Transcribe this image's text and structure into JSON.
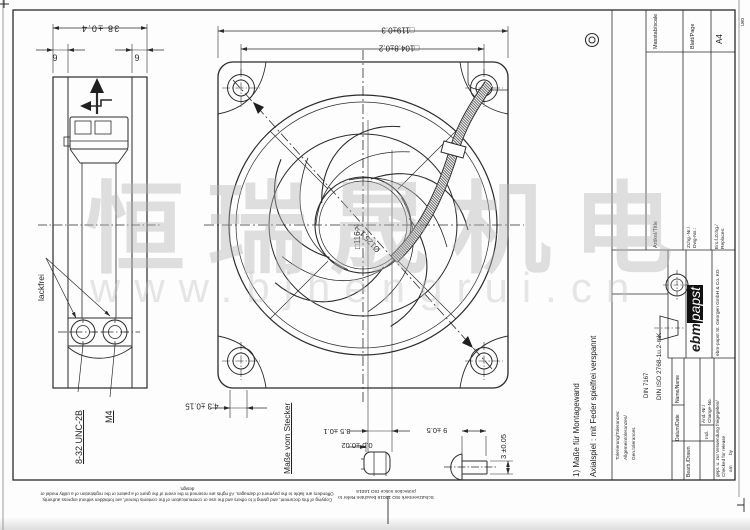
{
  "sheet": {
    "format": "A4",
    "edge_initials": "uvo"
  },
  "watermark": {
    "cjk": "恒瑞晟机电",
    "url": "www.bjhengrui.cn"
  },
  "dims": {
    "side_width": "38 ±0.4",
    "side_flange_l": "6",
    "side_flange_r": "6",
    "front_outer": "□119±0.3",
    "front_holes": "□104.8±0.2",
    "cutout_square": "□116 ¹)",
    "cutout_dia": "Ø125.1 ¹)",
    "plate_thk": "4.3 ±0.15",
    "plug_lip": "0.5 ±0.02",
    "plug_dia": "8.5 ±0.1",
    "pin_len": "9 ±0.5",
    "pin_dia": "3 ±0.05"
  },
  "labels": {
    "paint_free": "lackfrei",
    "thread_unc": "8-32 UNC-2B",
    "thread_m4": "M4",
    "plug_title": "Maße vom Stecker"
  },
  "notes": {
    "footnote1": "1) Maße für Montagewand",
    "footnote2": "Axialspiel : mit Feder spielfrei verspannt",
    "protect_de": "Schutzvermerk ISO 16016 beachten",
    "protect_en": "Refer to protection notice ISO 16016",
    "copyright": "Copying of this document, and giving it to others and the use or communication of the contents thereof, are forbidden without express authority. Offenders are liable to the payment of damages. All rights are reserved in the event of the grant of a patent or the registration of a utility model or design."
  },
  "titleblock": {
    "scale_label": "Masstab/scale",
    "sheet_label": "Blatt/Page",
    "sheet_value": "A4",
    "article_label": "Artikel/Title",
    "dwg_label1": "Zchg.-Nr./",
    "dwg_label2": "Dwg-No.:",
    "repl_label1": "Ers.f.Zchg./",
    "repl_label2": "Replaces:",
    "tol_label1": "Tolerierung/Tolerances:",
    "tol_label2": "Allgemeintoleranzen/",
    "tol_label3": "Gen.tolerances",
    "tol_value1": "DIN 7167",
    "tol_value2": "DIN ISO 2768-1u.2-mK",
    "drawn_label": "Bearb./Drawn",
    "date_label": "Datum/Date",
    "name_label": "Name/Name",
    "ind_label": "Ind.",
    "change_label1": "Änd.-Nr./",
    "change_label2": "Change-No.",
    "release_label1": "gepr. u. zur Verwendung freigegeben/",
    "release_label2": "Checked for release",
    "release_am": "am",
    "release_by": "by",
    "logo_ebm": "ebm",
    "logo_papst": "papst",
    "company": "ebm-papst St. Georgen GmbH & Co. KG"
  }
}
